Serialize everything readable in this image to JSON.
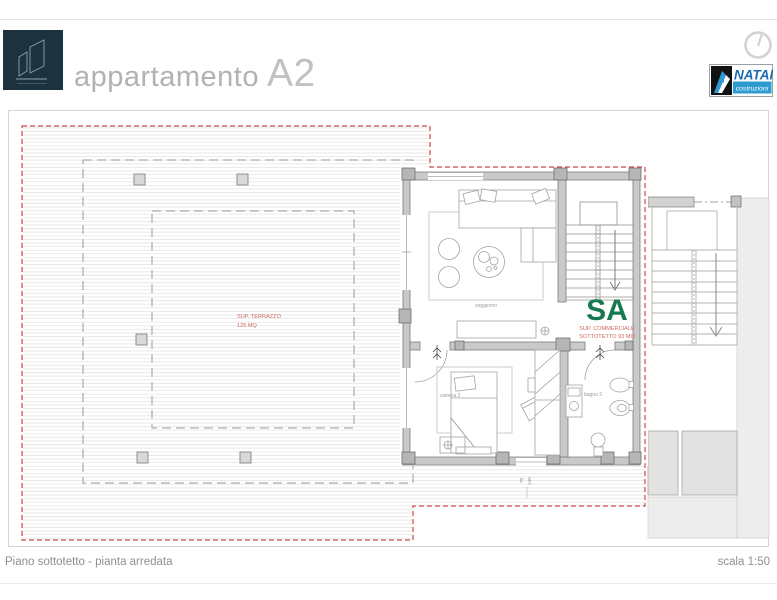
{
  "header": {
    "title": "appartamento",
    "unit": "A2"
  },
  "brand": {
    "name": "NATAN",
    "tagline": "costruzioni"
  },
  "plan": {
    "terrace": {
      "label": "SUP. TERRAZZO",
      "area": "125 MQ"
    },
    "commercial": {
      "code": "SA",
      "line1": "SUP. COMMERCIALE",
      "line2": "SOTTOTETTO 93 MQ"
    },
    "rooms": {
      "living": "soggiorno",
      "bedroom": "camera 2",
      "bathroom": "bagno 2"
    },
    "dimension": {
      "a": "70",
      "b": "140"
    }
  },
  "footer": {
    "caption": "Piano sottotetto - pianta arredata",
    "scale": "scala 1:50"
  },
  "colors": {
    "accent_red": "#c8524a",
    "accent_green": "#17794f",
    "brand_blue": "#1a6bb0",
    "brand_cyan": "#2e9ad2",
    "logo_bg": "#1c333f"
  }
}
